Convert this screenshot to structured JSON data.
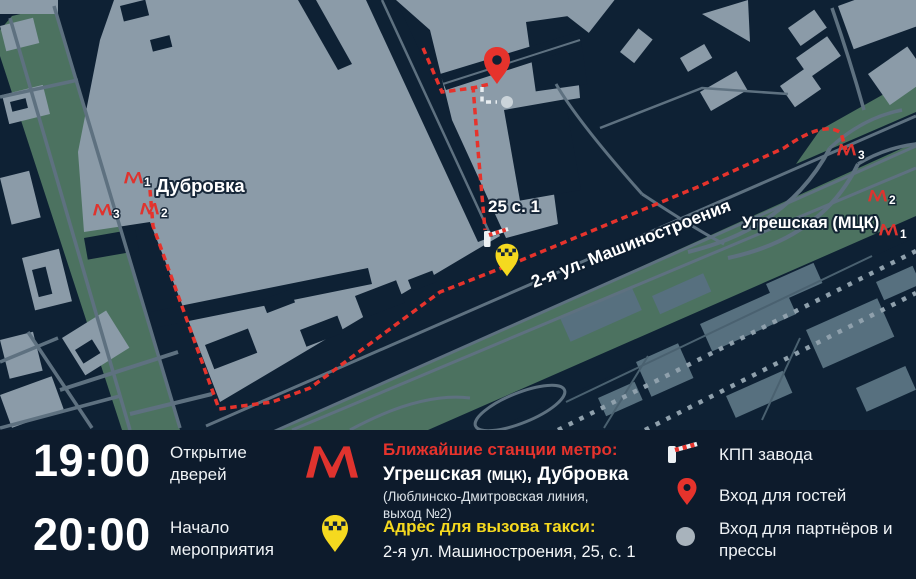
{
  "colors": {
    "map_background": "#0E2134",
    "panel_background": "#0D1B2C",
    "building_light": "#8B9BA8",
    "building_muted": "#57707F",
    "park_green": "#4C7260",
    "road_gray": "#5E7180",
    "route_red": "#E6332C",
    "metro_red": "#DF332E",
    "taxi_yellow": "#F5D91F",
    "text_white": "#FFFFFF"
  },
  "map": {
    "station_label_left": "Дубровка",
    "station_label_right": "Угрешская (МЦК)",
    "building_label": "25 с. 1",
    "street_label": "2-я ул. Машиностроения",
    "metro_exit_numbers_left": {
      "m1": "1",
      "m2": "2",
      "m3": "3"
    },
    "metro_exit_numbers_right": {
      "m1": "1",
      "m2": "2",
      "m3": "3"
    },
    "icons": {
      "metro": "metro-logo",
      "guest_entrance": "red-map-pin",
      "taxi_point": "yellow-taxi-pin",
      "checkpoint": "barrier-gate",
      "partner_entrance": "gray-dot"
    }
  },
  "panel": {
    "schedule": [
      {
        "time": "19:00",
        "label": "Открытие дверей"
      },
      {
        "time": "20:00",
        "label": "Начало мероприятия"
      }
    ],
    "metro": {
      "heading": "Ближайшие станции метро:",
      "station_a": "Угрешская ",
      "station_a_suffix": "(МЦК)",
      "station_b": ", Дубровка",
      "line_details": "(Люблинско-Дмитровская линия,",
      "line_details2": "выход №2)"
    },
    "taxi": {
      "heading": "Адрес для вызова такси:",
      "address": "2-я ул. Машиностроения, 25, с. 1"
    },
    "legend": [
      {
        "label": "КПП завода"
      },
      {
        "label": "Вход для гостей"
      },
      {
        "label": "Вход для партнёров и прессы"
      }
    ]
  }
}
